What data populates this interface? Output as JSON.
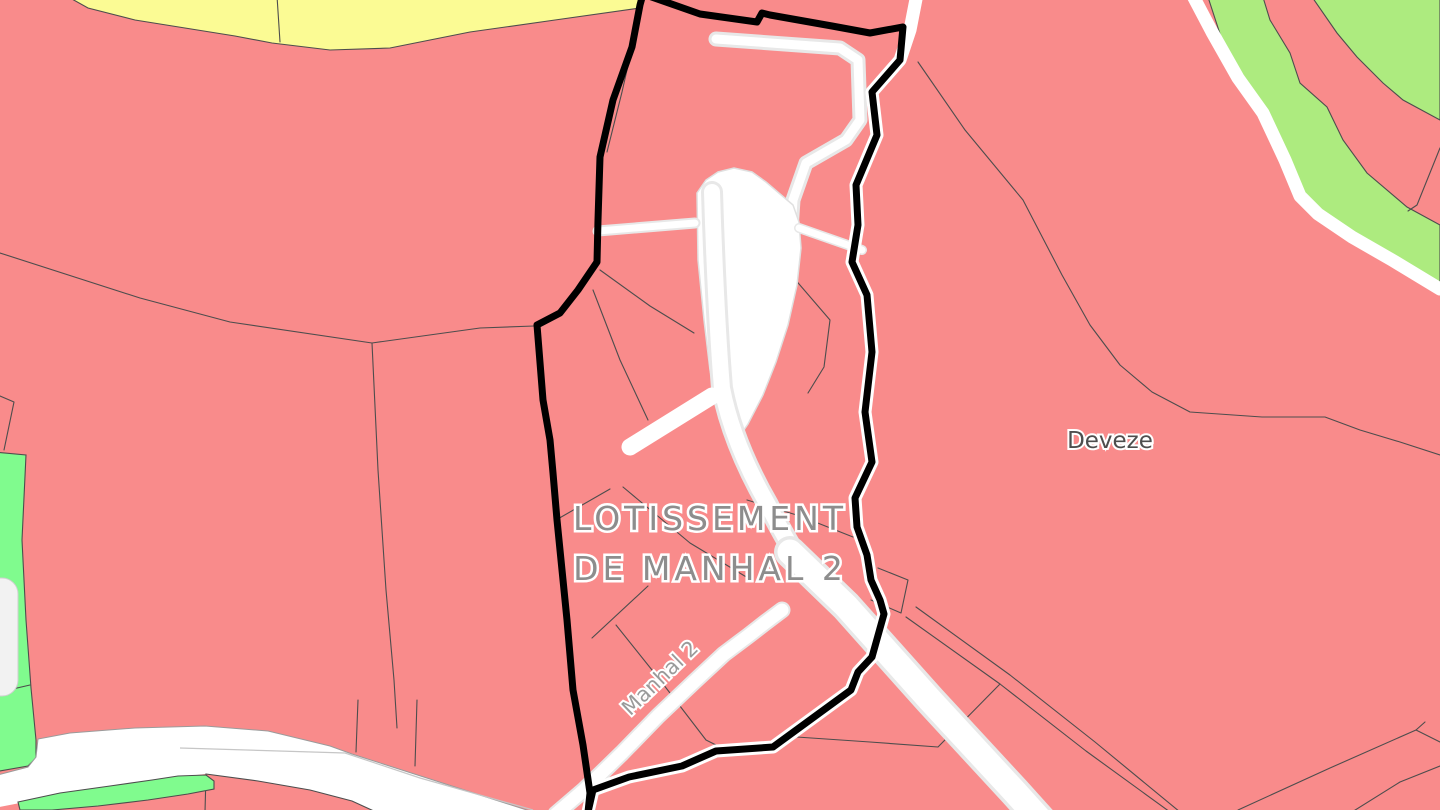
{
  "map": {
    "labels": {
      "lotissement_line1": "LOTISSEMENT",
      "lotissement_line2": "DE MANHAL 2",
      "place": "Deveze",
      "road": "Manhal 2"
    },
    "colors": {
      "zone_pink": "#f98b8b",
      "zone_yellow": "#fbfb94",
      "zone_light_green": "#adeb7f",
      "zone_bright_green": "#80fb8e",
      "road_white": "#ffffff",
      "road_grey": "#efefef",
      "open_area_white": "#ffffff",
      "open_area_grey": "#f2f2f2",
      "parcel_line": "#4d4d4d",
      "perimeter_black": "#000000",
      "title_grey": "#8d8d8d",
      "place_grey": "#4e4e4e",
      "road_label_grey": "#9a9a9a"
    }
  }
}
